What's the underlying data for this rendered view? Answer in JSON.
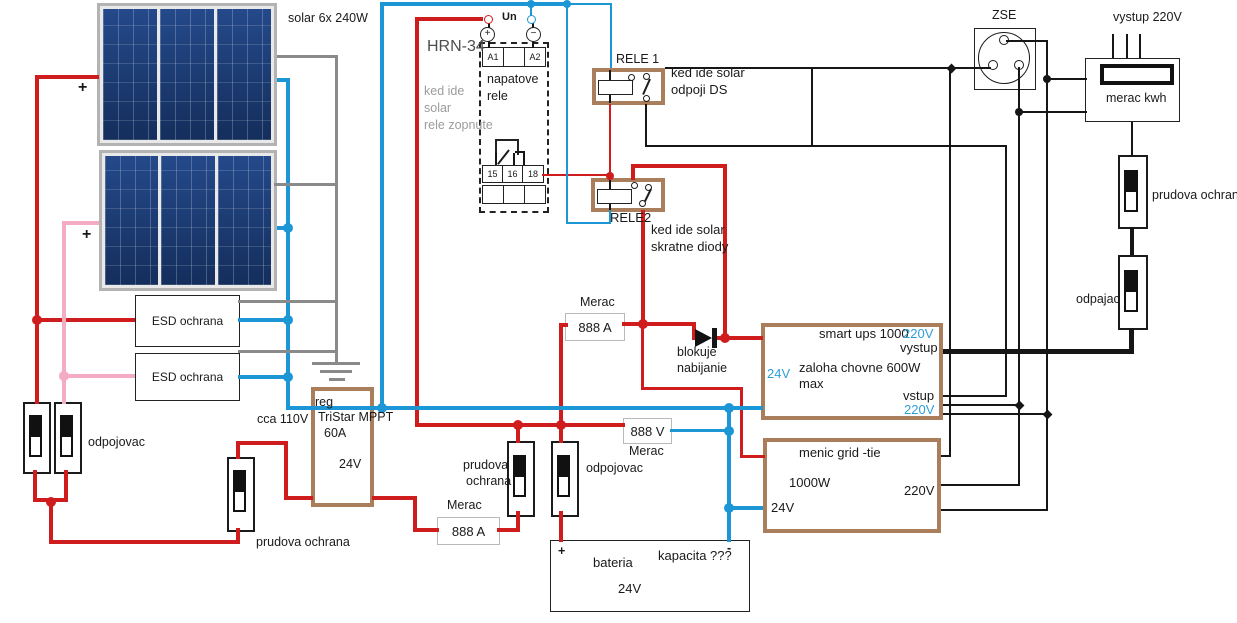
{
  "colors": {
    "red": "#cf1d1d",
    "pink": "#f3abc6",
    "blue": "#1d96d6",
    "gray": "#8a8a8a",
    "black": "#161616",
    "brown": "#ab7e5b",
    "blue_text": "#2e9fd6",
    "gray_text": "#9c9c9c"
  },
  "solar": {
    "label": "solar 6x 240W",
    "plus_top": "+",
    "plus_bottom": "+"
  },
  "esd": {
    "box1": "ESD ochrana",
    "box2": "ESD ochrana"
  },
  "left": {
    "odpojovac": "odpojovac",
    "prudova": "prudova ochrana",
    "cca": "cca 110V"
  },
  "hrn": {
    "title": "HRN-34",
    "un": "Un",
    "plus": "+",
    "minus": "−",
    "a1": "A1",
    "a2": "A2",
    "body1": "napatove",
    "body2": "rele",
    "note1": "ked ide",
    "note2": "solar",
    "note3": "rele zopnute",
    "t15": "15",
    "t16": "16",
    "t18": "18"
  },
  "rele1": {
    "label": "RELE 1",
    "note1": "ked ide solar",
    "note2": "odpoji DS"
  },
  "rele2": {
    "label": "RELE2",
    "note1": "ked ide solar",
    "note2": "skratne diody"
  },
  "reg": {
    "l1": "reg",
    "l2": "TriStar MPPT",
    "l3": "60A",
    "l4": "24V"
  },
  "merac_top": {
    "label": "Merac",
    "value": "888 A"
  },
  "merac_bot": {
    "label": "Merac",
    "value": "888 A"
  },
  "merac_v": {
    "label": "Merac",
    "value": "888 V"
  },
  "mid": {
    "prudova1": "prudova",
    "prudova2": "ochrana",
    "odpojovac": "odpojovac",
    "blokuje1": "blokuje",
    "blokuje2": "nabijanie"
  },
  "bateria": {
    "plus": "+",
    "minus": "-",
    "name": "bateria",
    "kapacita": "kapacita ???",
    "volt": "24V"
  },
  "ups": {
    "name": "smart ups 1000",
    "out_v": "220V",
    "out": "vystup",
    "in_v": "24V",
    "zaloha": "zaloha chovne 600W",
    "max": "max",
    "in": "vstup",
    "in_v2": "220V"
  },
  "menic": {
    "name": "menic grid -tie",
    "power": "1000W",
    "v220": "220V",
    "v24": "24V"
  },
  "right": {
    "zse": "ZSE",
    "vystup": "vystup 220V",
    "kwh": "merac kwh",
    "prudova": "prudova ochrana",
    "odpajac": "odpajac"
  }
}
